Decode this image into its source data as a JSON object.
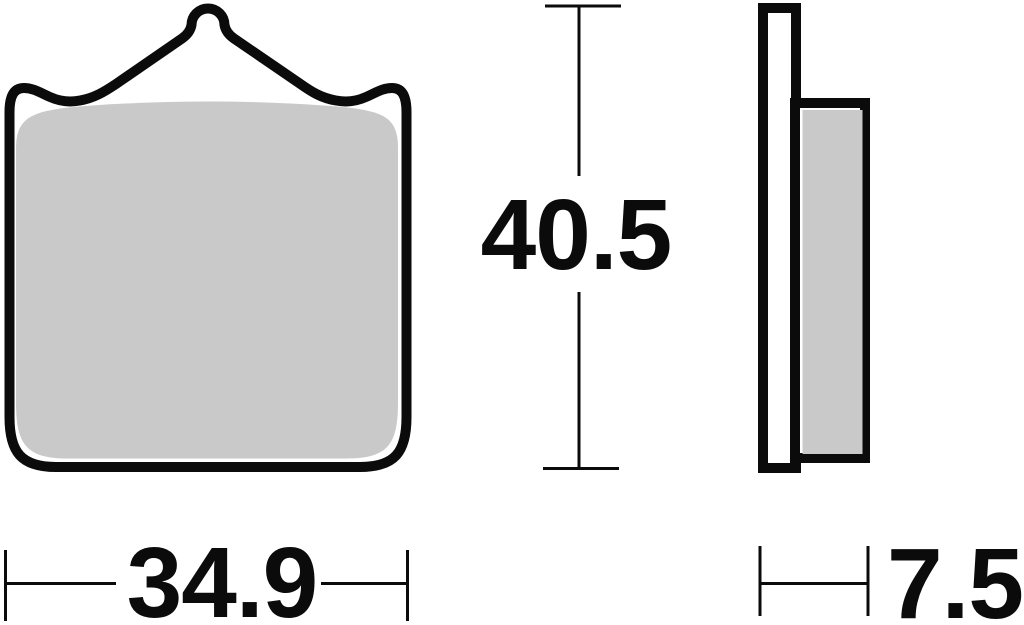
{
  "drawing": {
    "subject": "brake-pad-technical-drawing",
    "dimensions": {
      "width": "34.9",
      "height": "40.5",
      "thickness": "7.5"
    },
    "colors": {
      "outline": "#0b0b0b",
      "friction_material": "#c9c9c9",
      "backing_plate": "#ffffff",
      "background": "#ffffff"
    }
  }
}
